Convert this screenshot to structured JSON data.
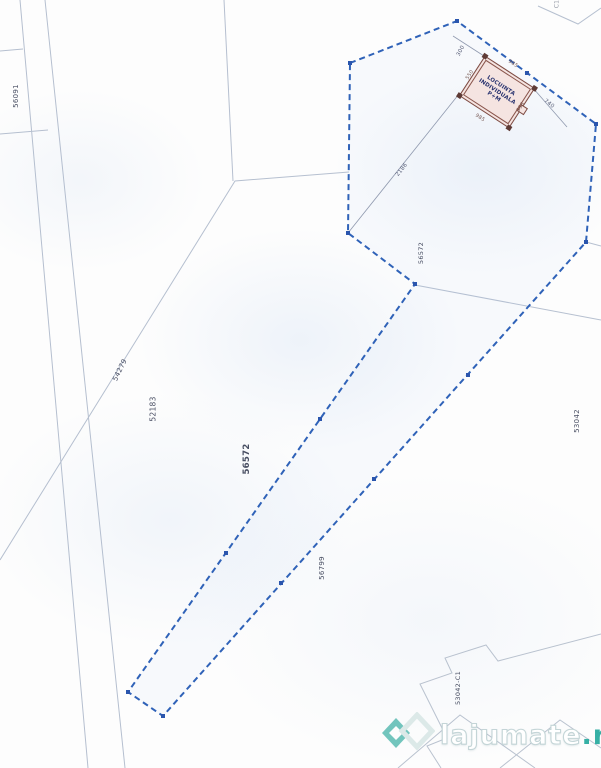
{
  "plan": {
    "building": {
      "label_line1": "LOCUINTA",
      "label_line2": "INDIVIDUALA",
      "label_line3": "P+M",
      "dim_top": "985",
      "dim_bottom": "985",
      "dim_left": "550",
      "dim_right": "558"
    },
    "dimensions": {
      "left_offset": "300",
      "right_offset": "740",
      "diagonal_offset": "2186"
    },
    "parcels": {
      "top_left_sliver": "56091",
      "along_diagonal": "54279",
      "left_field": "52183",
      "strip_center": "56572",
      "strip_top": "56572",
      "below_strip": "56799",
      "right_field": "53042",
      "corner_building": "53042-C1",
      "top_edge_partial": "C1"
    },
    "colors": {
      "boundary_blue": "#2f62b8",
      "parcel_line_gray": "#a9b5c9",
      "building_outline": "#7c4a42",
      "building_fill": "#f5e4e1"
    }
  },
  "watermark": {
    "logo_icon": "lajumate-logo",
    "brand_name": "lajumate",
    "brand_tld": ".ro",
    "brand_teal": "#36b0a5"
  }
}
